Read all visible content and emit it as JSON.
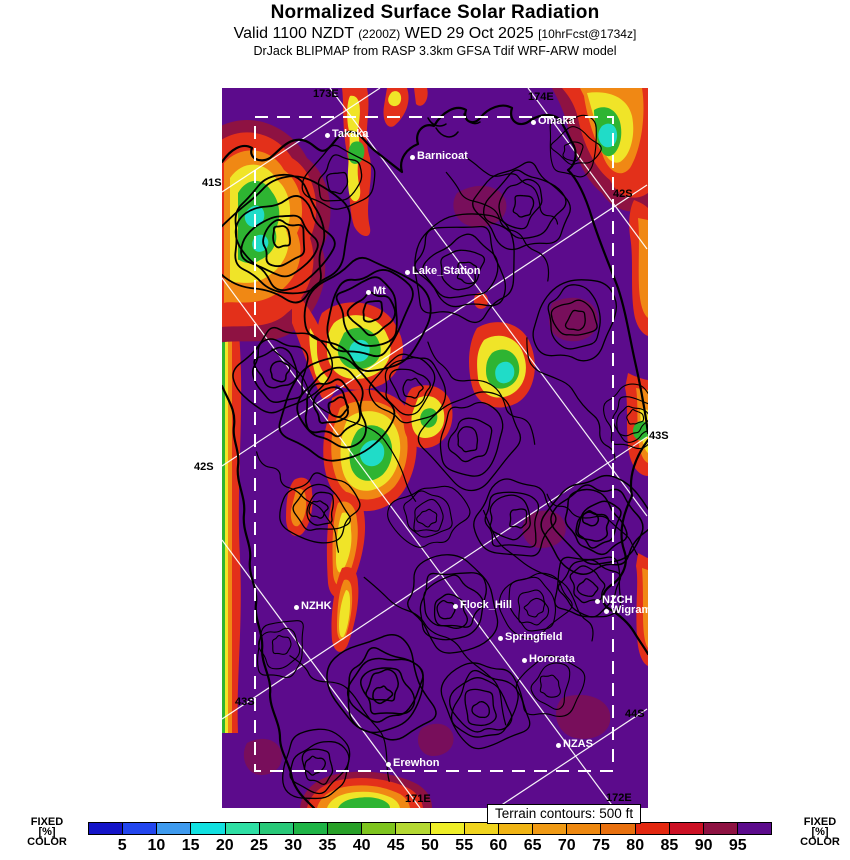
{
  "header": {
    "title": "Normalized Surface Solar Radiation",
    "valid_prefix": "Valid 1100 NZDT",
    "valid_zulu": "(2200Z)",
    "valid_date": "WED 29 Oct 2025",
    "forecast_info": "[10hrFcst@1734z]",
    "model_line": "DrJack BLIPMAP from RASP 3.3km GFSA Tdif WRF-ARW model"
  },
  "map": {
    "background_color": "#5c0b8c",
    "terrain_note": "Terrain contours: 500 ft",
    "stations": [
      {
        "name": "Takaka",
        "x": 105,
        "y": 47
      },
      {
        "name": "Barnicoat",
        "x": 190,
        "y": 69
      },
      {
        "name": "Omaka",
        "x": 311,
        "y": 34
      },
      {
        "name": "Lake_Station",
        "x": 185,
        "y": 184
      },
      {
        "name": "Mt",
        "x": 146,
        "y": 204
      },
      {
        "name": "NZHK",
        "x": 74,
        "y": 519
      },
      {
        "name": "Flock_Hill",
        "x": 233,
        "y": 518
      },
      {
        "name": "NZCH",
        "x": 375,
        "y": 513
      },
      {
        "name": "Wigram",
        "x": 384,
        "y": 523
      },
      {
        "name": "Springfield",
        "x": 278,
        "y": 550
      },
      {
        "name": "Hororata",
        "x": 302,
        "y": 572
      },
      {
        "name": "NZAS",
        "x": 336,
        "y": 657
      },
      {
        "name": "Erewhon",
        "x": 166,
        "y": 676
      }
    ],
    "inner_labels": [
      {
        "text": "173E",
        "x": 91,
        "y": 0
      },
      {
        "text": "174E",
        "x": 306,
        "y": 3
      },
      {
        "text": "171E",
        "x": 183,
        "y": 705
      },
      {
        "text": "172E",
        "x": 384,
        "y": 704
      },
      {
        "text": "42S",
        "x": 391,
        "y": 100
      },
      {
        "text": "43S",
        "x": 13,
        "y": 608
      },
      {
        "text": "44S",
        "x": 403,
        "y": 620
      }
    ],
    "outer_labels": [
      {
        "text": "41S",
        "x": 202,
        "y": 177
      },
      {
        "text": "42S",
        "x": 194,
        "y": 461
      },
      {
        "text": "43S",
        "x": 649,
        "y": 430
      }
    ]
  },
  "colorbar": {
    "side_label_lines": {
      "l1": "FIXED",
      "l2": "[%]",
      "l3": "COLOR"
    },
    "tick_values": [
      5,
      10,
      15,
      20,
      25,
      30,
      35,
      40,
      45,
      50,
      55,
      60,
      65,
      70,
      75,
      80,
      85,
      90,
      95
    ],
    "scale_min": 0,
    "scale_max": 100,
    "step": 5,
    "segments": [
      {
        "from": 0,
        "to": 5,
        "color": "#1414c8"
      },
      {
        "from": 5,
        "to": 10,
        "color": "#2346ee"
      },
      {
        "from": 10,
        "to": 15,
        "color": "#3e9aee"
      },
      {
        "from": 15,
        "to": 20,
        "color": "#11e0e0"
      },
      {
        "from": 20,
        "to": 25,
        "color": "#2edfa4"
      },
      {
        "from": 25,
        "to": 30,
        "color": "#28c878"
      },
      {
        "from": 30,
        "to": 35,
        "color": "#1eb446"
      },
      {
        "from": 35,
        "to": 40,
        "color": "#28a028"
      },
      {
        "from": 40,
        "to": 45,
        "color": "#7ec41e"
      },
      {
        "from": 45,
        "to": 50,
        "color": "#b4d832"
      },
      {
        "from": 50,
        "to": 55,
        "color": "#eeee28"
      },
      {
        "from": 55,
        "to": 60,
        "color": "#f0d41e"
      },
      {
        "from": 60,
        "to": 65,
        "color": "#f0b414"
      },
      {
        "from": 65,
        "to": 70,
        "color": "#f09a14"
      },
      {
        "from": 70,
        "to": 75,
        "color": "#ee8810"
      },
      {
        "from": 75,
        "to": 80,
        "color": "#e8700e"
      },
      {
        "from": 80,
        "to": 85,
        "color": "#e32810"
      },
      {
        "from": 85,
        "to": 90,
        "color": "#cc1024"
      },
      {
        "from": 90,
        "to": 95,
        "color": "#8e1242"
      },
      {
        "from": 95,
        "to": 100,
        "color": "#5c0b8c"
      }
    ]
  }
}
